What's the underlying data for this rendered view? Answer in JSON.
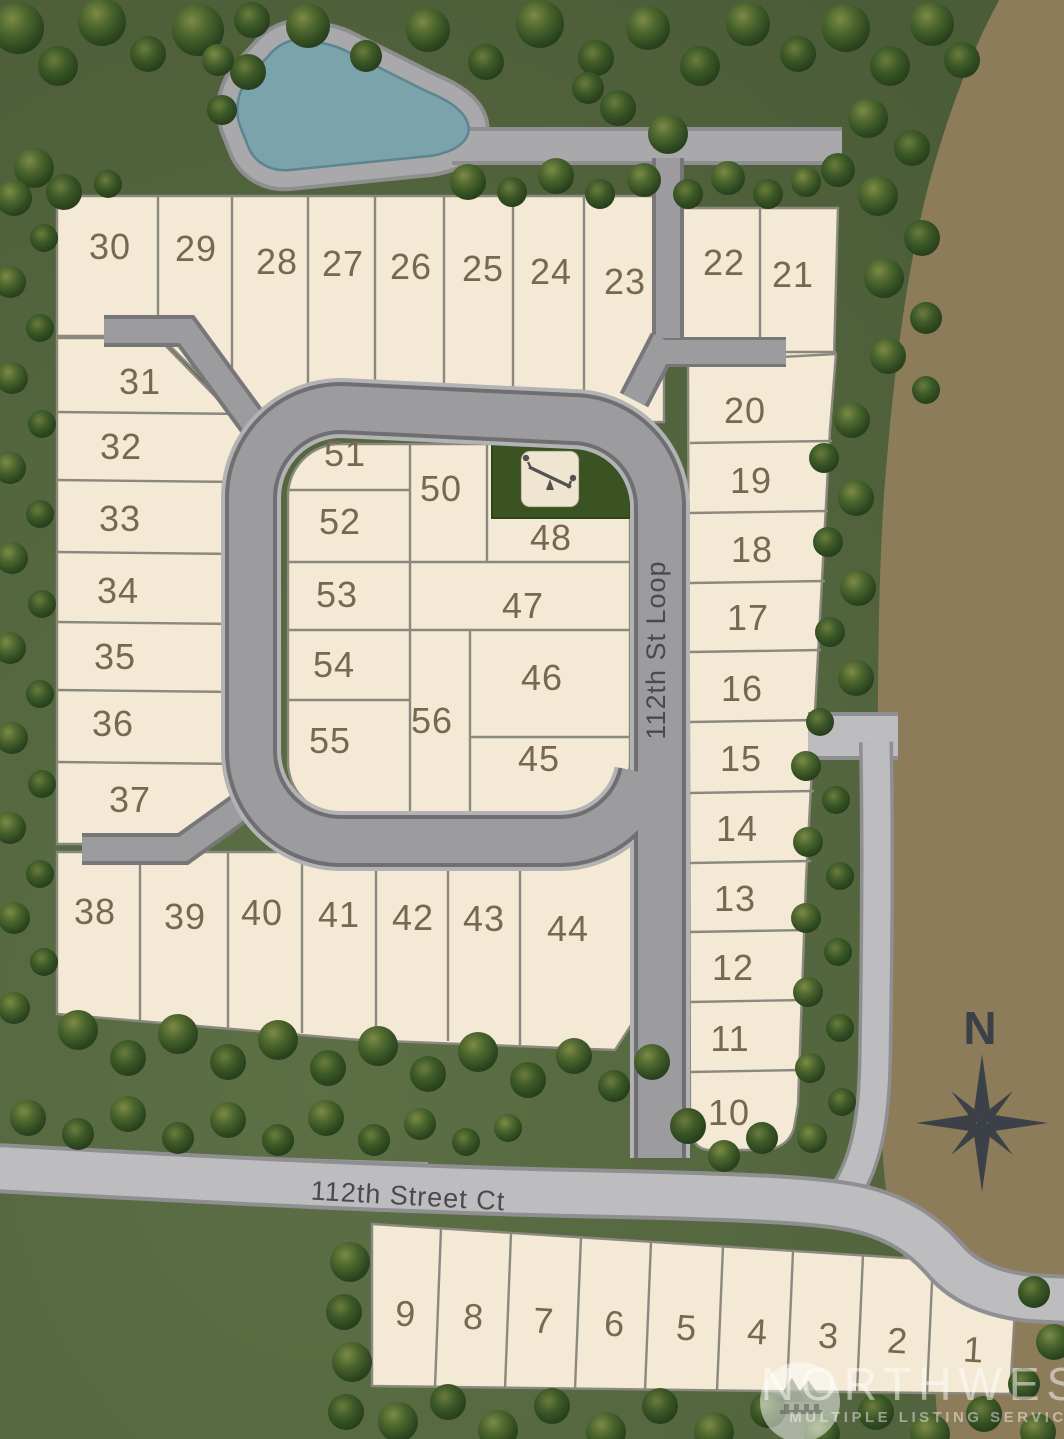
{
  "map_title": "Residential plat site map",
  "streets": {
    "loop": "112th St Loop",
    "court": "112th Street Ct"
  },
  "compass": {
    "north": "N"
  },
  "watermark": {
    "brand": "NORTHWEST",
    "tagline": "MULTIPLE LISTING SERVICE®"
  },
  "icons": {
    "playground": "seesaw-icon",
    "compass": "compass-rose-icon",
    "watermark_logo": "mountain-trees-logo-icon"
  },
  "lot_numbers": [
    "1",
    "2",
    "3",
    "4",
    "5",
    "6",
    "7",
    "8",
    "9",
    "10",
    "11",
    "12",
    "13",
    "14",
    "15",
    "16",
    "17",
    "18",
    "19",
    "20",
    "21",
    "22",
    "23",
    "24",
    "25",
    "26",
    "27",
    "28",
    "29",
    "30",
    "31",
    "32",
    "33",
    "34",
    "35",
    "36",
    "37",
    "38",
    "39",
    "40",
    "41",
    "42",
    "43",
    "44",
    "45",
    "46",
    "47",
    "48",
    "49",
    "50",
    "51",
    "52",
    "53",
    "54",
    "55",
    "56"
  ],
  "colors": {
    "grass": "#53653e",
    "dirt": "#8d7c59",
    "lot_fill": "#f3e9d4",
    "lot_line": "#8b897f",
    "road_dark": "#9c9c9f",
    "road_medium": "#a9a9ac",
    "road_light": "#bdbdbf",
    "pond": "#7ba3ac",
    "playground_green": "#3b5322",
    "lot_number_color": "#77684f",
    "street_label_color": "#4a4a4c",
    "compass_color": "#3c4148"
  }
}
